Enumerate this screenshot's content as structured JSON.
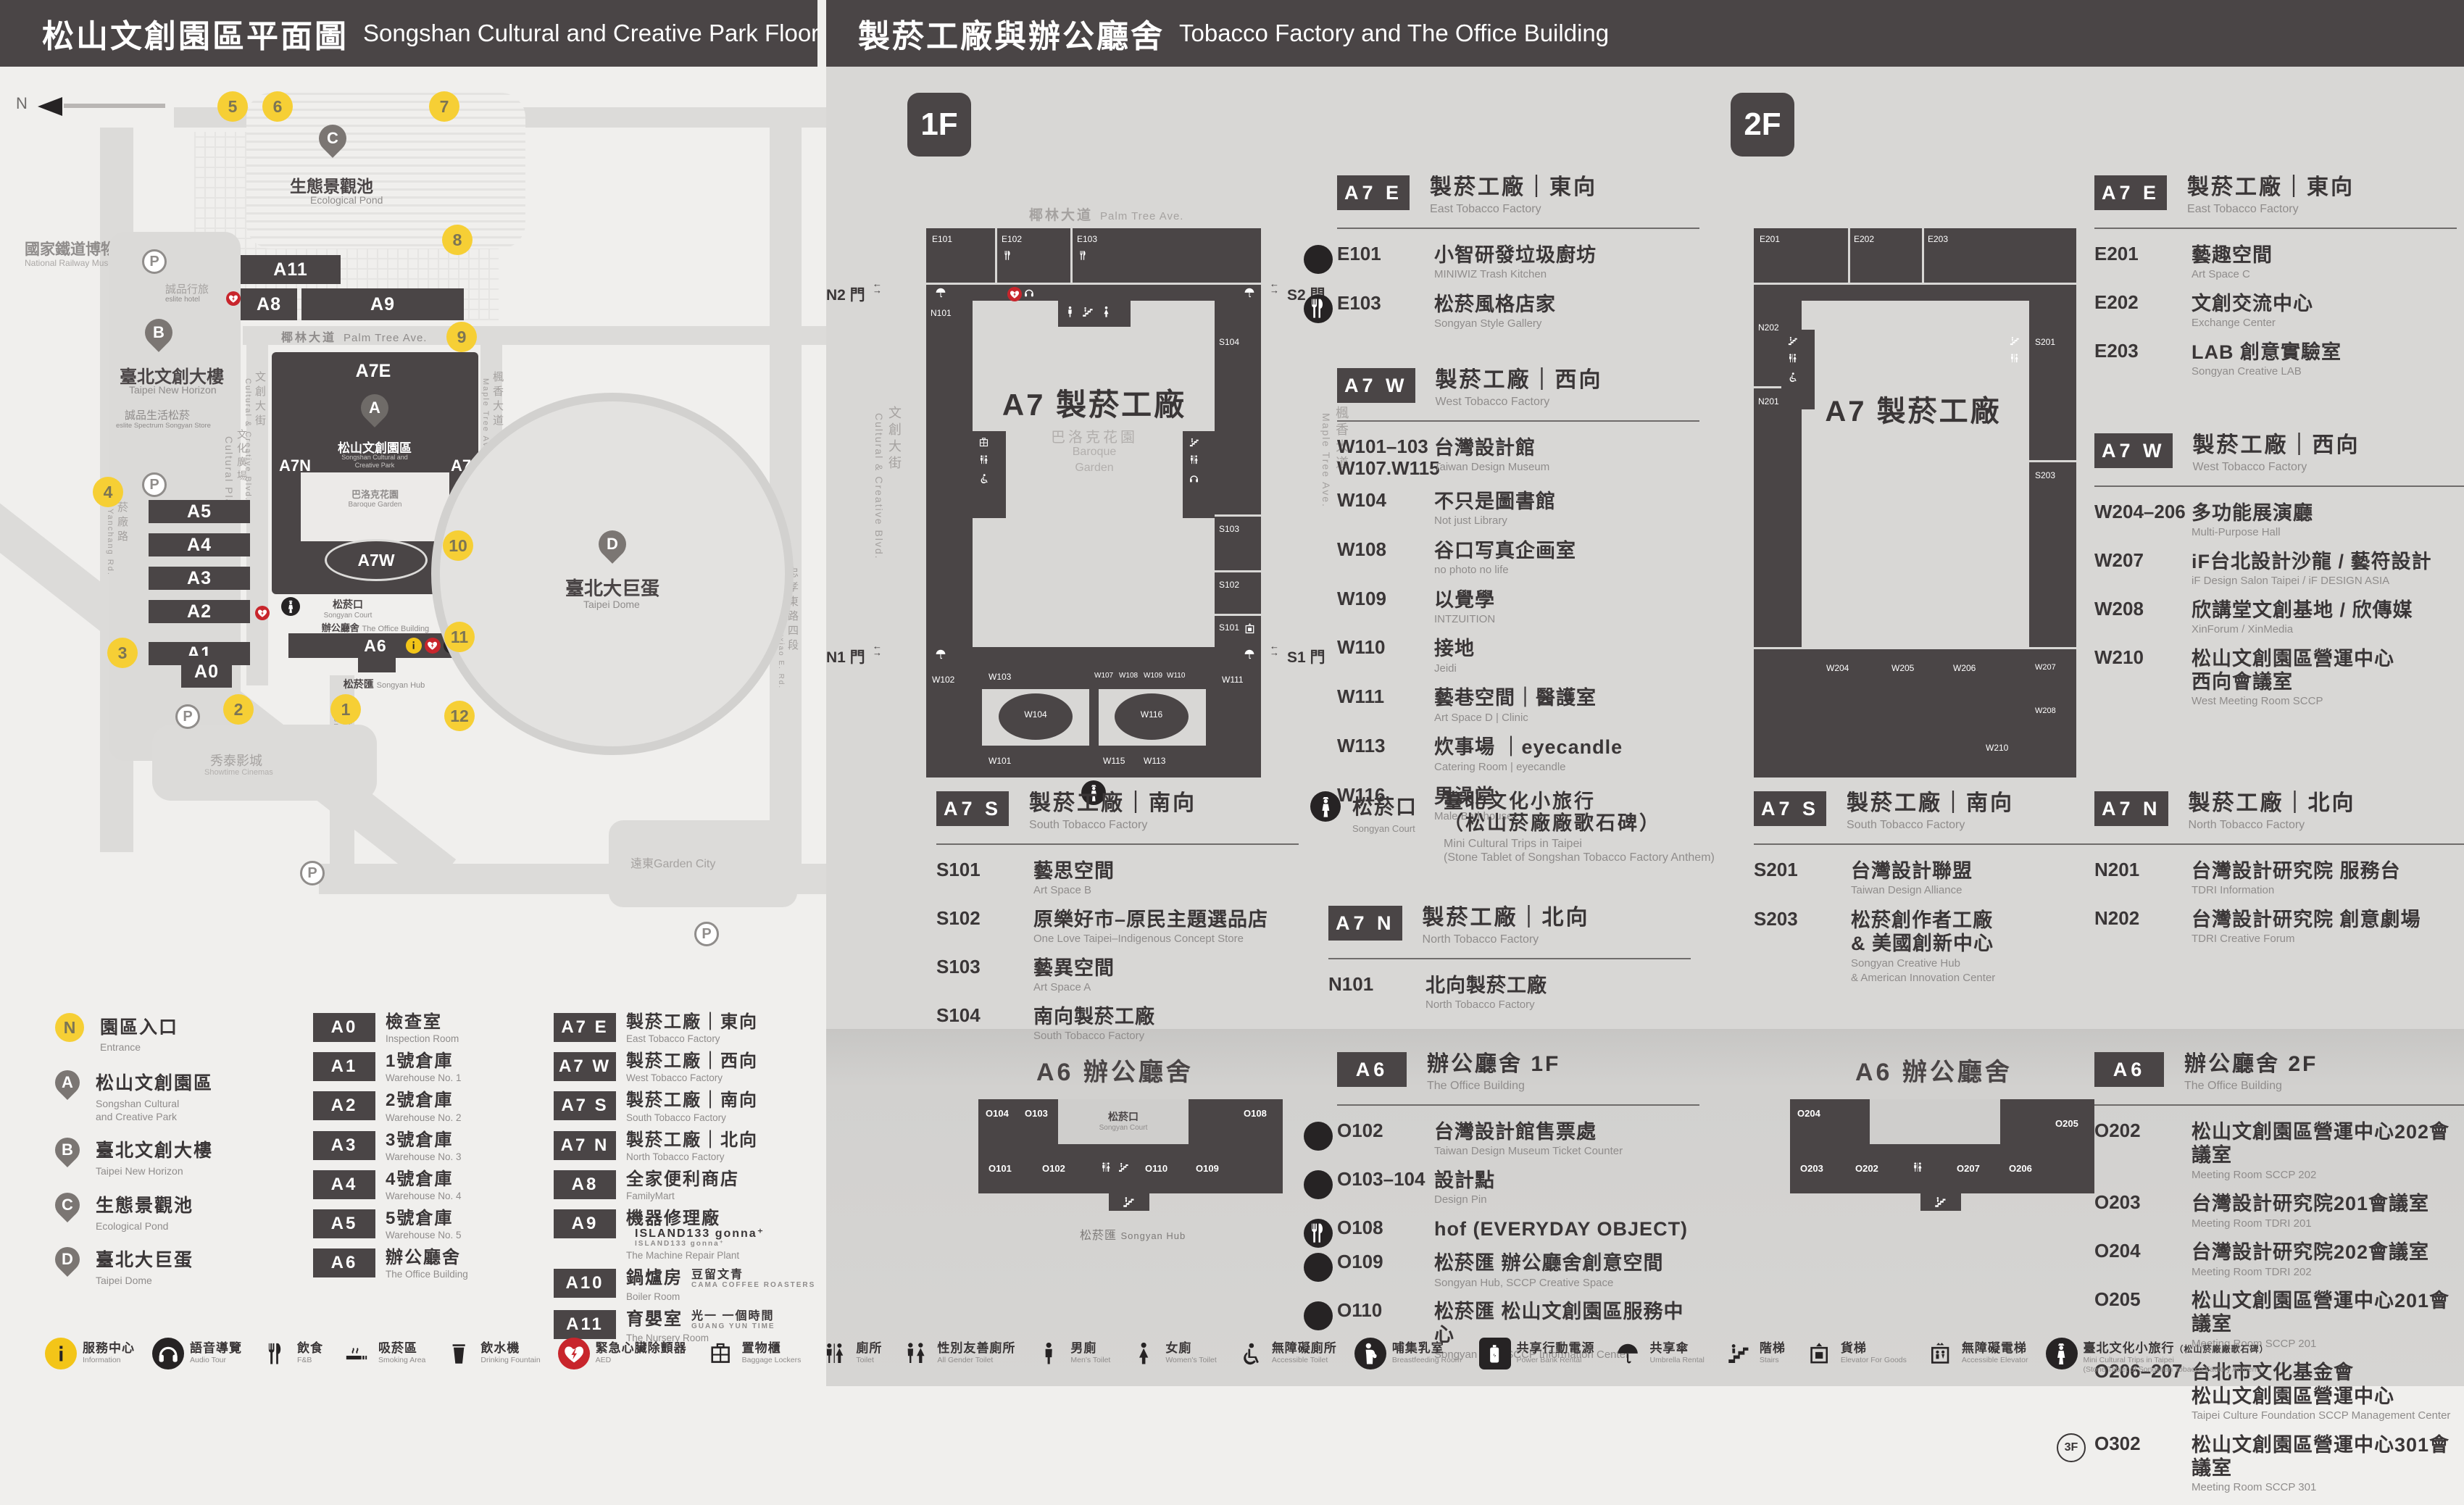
{
  "header": {
    "left": {
      "zh": "松山文創園區平面圖",
      "en": "Songshan Cultural and Creative Park Floor Plan"
    },
    "right": {
      "zh": "製菸工廠與辦公廳舍",
      "en": "Tobacco Factory and The Office Building"
    }
  },
  "map": {
    "compass": "N",
    "railway_museum": {
      "zh": "國家鐵道博物館",
      "en": "National Railway Museum"
    },
    "pond": {
      "pin": "C",
      "zh": "生態景觀池",
      "en": "Ecological Pond"
    },
    "new_horizon": {
      "pin": "B",
      "zh": "臺北文創大樓",
      "en": "Taipei New Horizon"
    },
    "eslite_hotel": {
      "zh": "誠品行旅",
      "en": "eslite hotel"
    },
    "eslite_mall": {
      "zh": "誠品生活松菸",
      "en": "eslite Spectrum Songyan Store"
    },
    "cultural_plaza": {
      "zh": "文化廣場",
      "en": "Cultural Plaza"
    },
    "park": {
      "pin": "A",
      "zh": "松山文創園區",
      "en1": "Songshan Cultural and",
      "en2": "Creative Park"
    },
    "baroque": {
      "zh": "巴洛克花園",
      "en": "Baroque Garden"
    },
    "court": {
      "zh": "松菸口",
      "en": "Songyan Court"
    },
    "office": {
      "zh": "辦公廳舍",
      "en": "The Office Building"
    },
    "hub": {
      "zh": "松菸匯",
      "en": "Songyan Hub"
    },
    "dome": {
      "pin": "D",
      "zh": "臺北大巨蛋",
      "en": "Taipei Dome"
    },
    "showtime": {
      "zh": "秀泰影城",
      "en": "Showtime Cinemas"
    },
    "garden_city": {
      "zh": "遠東Garden City"
    },
    "roads": {
      "palm": {
        "zh": "椰林大道",
        "en": "Palm Tree Ave."
      },
      "cultural": {
        "zh": "文創大街",
        "en": "Cultural & Creative Blvd."
      },
      "maple": {
        "zh": "楓香大道",
        "en": "Maple Tree Ave."
      },
      "yanchang": {
        "zh": "菸廠路",
        "en": "Yanchang Rd."
      },
      "songyan": {
        "zh": "松菸大道",
        "en": "Songyan Ave."
      },
      "zhongxiao": {
        "zh": "忠孝東路四段",
        "en": "Sec. 4, Zhongxiao E. Rd."
      }
    },
    "blocks": {
      "a11": "A11",
      "a8": "A8",
      "a9": "A9",
      "a7e": "A7E",
      "a7n": "A7N",
      "a7s": "A7S",
      "a7w": "A7W",
      "a6": "A6",
      "a5": "A5",
      "a4": "A4",
      "a3": "A3",
      "a2": "A2",
      "a1": "A1",
      "a0": "A0"
    },
    "entrances": [
      "1",
      "2",
      "3",
      "4",
      "5",
      "6",
      "7",
      "8",
      "9",
      "10",
      "11",
      "12"
    ],
    "parking": "P"
  },
  "park_legend": {
    "entrance": {
      "badge": "N",
      "zh": "園區入口",
      "en": "Entrance"
    },
    "pins": [
      {
        "badge": "A",
        "zh": "松山文創園區",
        "en": "Songshan Cultural",
        "en2": "and Creative Park"
      },
      {
        "badge": "B",
        "zh": "臺北文創大樓",
        "en": "Taipei New Horizon"
      },
      {
        "badge": "C",
        "zh": "生態景觀池",
        "en": "Ecological Pond"
      },
      {
        "badge": "D",
        "zh": "臺北大巨蛋",
        "en": "Taipei Dome"
      }
    ]
  },
  "building_legend": {
    "col1": [
      {
        "code": "A0",
        "zh": "檢查室",
        "en": "Inspection Room",
        "icons": []
      },
      {
        "code": "A1",
        "zh": "1號倉庫",
        "en": "Warehouse No. 1",
        "icons": [
          "goods-elevator-icon",
          "toilet-icon"
        ]
      },
      {
        "code": "A2",
        "zh": "2號倉庫",
        "en": "Warehouse No. 2",
        "icons": [
          "aed-icon"
        ]
      },
      {
        "code": "A3",
        "zh": "3號倉庫",
        "en": "Warehouse No. 3",
        "icons": []
      },
      {
        "code": "A4",
        "zh": "4號倉庫",
        "en": "Warehouse No. 4",
        "icons": []
      },
      {
        "code": "A5",
        "zh": "5號倉庫",
        "en": "Warehouse No. 5",
        "icons": []
      },
      {
        "code": "A6",
        "zh": "辦公廳舍",
        "en": "The Office Building",
        "icons": [
          "aed-icon",
          "toilet-icon",
          "fnb-icon",
          "info-icon"
        ]
      }
    ],
    "col2": [
      {
        "code": "A7 E",
        "zh": "製菸工廠｜東向",
        "en": "East Tobacco Factory",
        "icons": [
          "aed-icon",
          "toilet-icon",
          "fnb-icon"
        ]
      },
      {
        "code": "A7 W",
        "zh": "製菸工廠｜西向",
        "en": "West Tobacco Factory",
        "icons": [
          "mini-trips-icon",
          "toilet-icon"
        ]
      },
      {
        "code": "A7 S",
        "zh": "製菸工廠｜南向",
        "en": "South Tobacco Factory",
        "icons": [
          "toilet-icon"
        ]
      },
      {
        "code": "A7 N",
        "zh": "製菸工廠｜北向",
        "en": "North Tobacco Factory",
        "icons": [
          "toilet-icon"
        ]
      },
      {
        "code": "A8",
        "zh": "全家便利商店",
        "en": "FamilyMart",
        "icons": [
          "goods-elevator-icon",
          "aed-icon",
          "fnb-icon"
        ]
      },
      {
        "code": "A9",
        "zh": "機器修理廠",
        "en": "The Machine Repair Plant",
        "brand": "ISLAND133 gonna⁺",
        "brand_sub": "ISLAND133 gonna⁺",
        "icons": [
          "fnb-icon"
        ]
      },
      {
        "code": "A10",
        "zh": "鍋爐房",
        "en": "Boiler Room",
        "brand": "豆留文青",
        "brand_sub": "CAMA COFFEE ROASTERS",
        "icons": [
          "fnb-icon"
        ]
      },
      {
        "code": "A11",
        "zh": "育嬰室",
        "en": "The Nursery Room",
        "brand": "光一 一個時間",
        "brand_sub": "GUANG YUN TIME",
        "icons": [
          "fnb-icon"
        ]
      }
    ]
  },
  "services": [
    {
      "icon": "info-icon",
      "cls": "ic-yellow-round",
      "zh": "服務中心",
      "en": "Information"
    },
    {
      "icon": "audio-tour-icon",
      "cls": "ic-black-round",
      "zh": "語音導覽",
      "en": "Audio Tour"
    },
    {
      "icon": "fnb-icon",
      "cls": "",
      "zh": "飲食",
      "en": "F&B"
    },
    {
      "icon": "smoking-icon",
      "cls": "",
      "zh": "吸菸區",
      "en": "Smoking Area"
    },
    {
      "icon": "drinking-fountain-icon",
      "cls": "",
      "zh": "飲水機",
      "en": "Drinking Fountain"
    },
    {
      "icon": "aed-icon",
      "cls": "ic-red-round",
      "zh": "緊急心臟除顫器",
      "en": "AED"
    },
    {
      "icon": "lockers-icon",
      "cls": "",
      "zh": "置物櫃",
      "en": "Baggage Lockers"
    },
    {
      "icon": "toilet-icon",
      "cls": "",
      "zh": "廁所",
      "en": "Toilet"
    },
    {
      "icon": "all-gender-toilet-icon",
      "cls": "",
      "zh": "性別友善廁所",
      "en": "All Gender Toilet"
    },
    {
      "icon": "mens-toilet-icon",
      "cls": "",
      "zh": "男廁",
      "en": "Men's Toilet"
    },
    {
      "icon": "womens-toilet-icon",
      "cls": "",
      "zh": "女廁",
      "en": "Women's Toilet"
    },
    {
      "icon": "accessible-toilet-icon",
      "cls": "",
      "zh": "無障礙廁所",
      "en": "Accessible Toilet"
    },
    {
      "icon": "breastfeeding-icon",
      "cls": "ic-black-round",
      "zh": "哺集乳室",
      "en": "Breastfeeding Room"
    },
    {
      "icon": "power-bank-icon",
      "cls": "ic-dark-square",
      "zh": "共享行動電源",
      "en": "Power Bank Rental"
    },
    {
      "icon": "umbrella-icon",
      "cls": "",
      "zh": "共享傘",
      "en": "Umbrella Rental"
    },
    {
      "icon": "stairs-icon",
      "cls": "",
      "zh": "階梯",
      "en": "Stairs"
    },
    {
      "icon": "goods-elevator-icon",
      "cls": "",
      "zh": "貨梯",
      "en": "Elevator For Goods"
    },
    {
      "icon": "accessible-elevator-icon",
      "cls": "",
      "zh": "無障礙電梯",
      "en": "Accessible Elevator"
    },
    {
      "icon": "mini-trips-icon",
      "cls": "ic-black-round",
      "zh": "臺北文化小旅行",
      "zh_small": "（松山菸廠廠歌石碑）",
      "en": "Mini Cultural Trips in Taipei",
      "en2": "(Stone Tablet of Songshan Tobacco Factory Anthem)"
    }
  ],
  "floor1": {
    "badge": "1F",
    "plan": {
      "road_top_zh": "椰林大道",
      "road_top_en": "Palm Tree Ave.",
      "road_left_zh": "文創大街",
      "road_left_en": "Cultural & Creative Blvd.",
      "road_right_zh": "楓香大道",
      "road_right_en": "Maple Tree Ave.",
      "center": "A7 製菸工廠",
      "courtyard_zh": "巴洛克花園",
      "courtyard_en1": "Baroque",
      "courtyard_en2": "Garden",
      "gate_n2": "N2 門",
      "gate_s2": "S2 門",
      "gate_n1": "N1 門",
      "gate_s1": "S1 門",
      "rooms": {
        "e101": "E101",
        "e102": "E102",
        "e103": "E103",
        "n101": "N101",
        "s104": "S104",
        "s103": "S103",
        "s102": "S102",
        "s101": "S101",
        "w102": "W102",
        "w103": "W103",
        "w104": "W104",
        "w101": "W101",
        "w107": "W107",
        "w108": "W108",
        "w109": "W109",
        "w110": "W110",
        "w111": "W111",
        "w115": "W115",
        "w113": "W113",
        "w116": "W116"
      }
    },
    "a7e": {
      "code": "A7 E",
      "zh": "製菸工廠｜東向",
      "en": "East Tobacco Factory",
      "rooms": [
        {
          "code": "E101",
          "zh": "小智研發垃圾廚坊",
          "en": "MINIWIZ Trash Kitchen"
        },
        {
          "code": "E103",
          "zh": "松菸風格店家",
          "en": "Songyan Style Gallery",
          "icon": "fnb-icon"
        }
      ]
    },
    "a7w": {
      "code": "A7 W",
      "zh": "製菸工廠｜西向",
      "en": "West Tobacco Factory",
      "rooms": [
        {
          "code": "W101–103",
          "code2": "W107.W115",
          "zh": "台灣設計館",
          "en": "Taiwan Design Museum"
        },
        {
          "code": "W104",
          "zh": "不只是圖書館",
          "en": "Not just Library"
        },
        {
          "code": "W108",
          "zh": "谷口写真企画室",
          "en": "no photo no life"
        },
        {
          "code": "W109",
          "zh": "以覺學",
          "en": "INTZUITION"
        },
        {
          "code": "W110",
          "zh": "接地",
          "en": "Jeidi"
        },
        {
          "code": "W111",
          "zh": "藝巷空間｜醫護室",
          "en": "Art Space D | Clinic"
        },
        {
          "code": "W113",
          "zh": "炊事場 ｜eyecandle",
          "en": "Catering Room | eyecandle"
        },
        {
          "code": "W116",
          "zh": "男澡堂",
          "en": "Male Bathhouse"
        }
      ]
    },
    "a7s": {
      "code": "A7 S",
      "zh": "製菸工廠｜南向",
      "en": "South Tobacco Factory",
      "rooms": [
        {
          "code": "S101",
          "zh": "藝思空間",
          "en": "Art Space B"
        },
        {
          "code": "S102",
          "zh": "原樂好市–原民主題選品店",
          "en": "One Love Taipei–Indigenous Concept Store"
        },
        {
          "code": "S103",
          "zh": "藝異空間",
          "en": "Art Space A"
        },
        {
          "code": "S104",
          "zh": "南向製菸工廠",
          "en": "South Tobacco Factory"
        }
      ]
    },
    "court": {
      "zh": "松菸口",
      "en": "Songyan Court",
      "name_zh": "臺北文化小旅行",
      "name_zh2": "（松山菸廠廠歌石碑）",
      "name_en": "Mini Cultural Trips in Taipei",
      "name_en2": "(Stone Tablet of Songshan Tobacco Factory Anthem)"
    },
    "a7n": {
      "code": "A7 N",
      "zh": "製菸工廠｜北向",
      "en": "North Tobacco Factory",
      "rooms": [
        {
          "code": "N101",
          "zh": "北向製菸工廠",
          "en": "North Tobacco Factory"
        }
      ]
    }
  },
  "floor2": {
    "badge": "2F",
    "plan": {
      "center": "A7 製菸工廠",
      "rooms": {
        "e201": "E201",
        "e202": "E202",
        "e203": "E203",
        "n202": "N202",
        "n201": "N201",
        "s201": "S201",
        "s203": "S203",
        "w204": "W204",
        "w205": "W205",
        "w206": "W206",
        "w207": "W207",
        "w208": "W208",
        "w210": "W210"
      }
    },
    "a7e": {
      "code": "A7 E",
      "zh": "製菸工廠｜東向",
      "en": "East Tobacco Factory",
      "rooms": [
        {
          "code": "E201",
          "zh": "藝趣空間",
          "en": "Art Space C"
        },
        {
          "code": "E202",
          "zh": "文創交流中心",
          "en": "Exchange Center"
        },
        {
          "code": "E203",
          "zh": "LAB 創意實驗室",
          "en": "Songyan Creative LAB"
        }
      ]
    },
    "a7w": {
      "code": "A7 W",
      "zh": "製菸工廠｜西向",
      "en": "West Tobacco Factory",
      "rooms": [
        {
          "code": "W204–206",
          "zh": "多功能展演廳",
          "en": "Multi-Purpose Hall"
        },
        {
          "code": "W207",
          "zh": "iF台北設計沙龍 / 藝符設計",
          "en": "iF Design Salon Taipei / iF DESIGN ASIA"
        },
        {
          "code": "W208",
          "zh": "欣講堂文創基地 / 欣傳媒",
          "en": "XinForum / XinMedia"
        },
        {
          "code": "W210",
          "zh": "松山文創園區營運中心",
          "zh2": "西向會議室",
          "en": "West Meeting Room SCCP"
        }
      ]
    },
    "a7s": {
      "code": "A7 S",
      "zh": "製菸工廠｜南向",
      "en": "South Tobacco Factory",
      "rooms": [
        {
          "code": "S201",
          "zh": "台灣設計聯盟",
          "en": "Taiwan Design Alliance"
        },
        {
          "code": "S203",
          "zh": "松菸創作者工廠",
          "zh2": "& 美國創新中心",
          "en": "Songyan Creative Hub",
          "en2": "& American Innovation Center"
        }
      ]
    },
    "a7n": {
      "code": "A7 N",
      "zh": "製菸工廠｜北向",
      "en": "North Tobacco Factory",
      "rooms": [
        {
          "code": "N201",
          "zh": "台灣設計研究院 服務台",
          "en": "TDRI Information"
        },
        {
          "code": "N202",
          "zh": "台灣設計研究院 創意劇場",
          "en": "TDRI Creative Forum"
        }
      ]
    }
  },
  "a6f1": {
    "code": "A6",
    "zh": "辦公廳舍 1F",
    "en": "The Office Building",
    "plan_title": "A6 辦公廳舍",
    "plan": {
      "o104": "O104",
      "o103": "O103",
      "o108": "O108",
      "o101": "O101",
      "o102": "O102",
      "o110": "O110",
      "o109": "O109",
      "court_zh": "松菸口",
      "court_en": "Songyan Court",
      "hub_zh": "松菸匯",
      "hub_en": "Songyan Hub"
    },
    "rooms": [
      {
        "code": "O102",
        "zh": "台灣設計館售票處",
        "en": "Taiwan Design Museum Ticket Counter"
      },
      {
        "code": "O103–104",
        "zh": "設計點",
        "en": "Design Pin"
      },
      {
        "code": "O108",
        "zh": "hof (EVERYDAY OBJECT)",
        "icon": "fnb-icon"
      },
      {
        "code": "O109",
        "zh": "松菸匯 辦公廳舍創意空間",
        "en": "Songyan Hub, SCCP Creative Space"
      },
      {
        "code": "O110",
        "zh": "松菸匯 松山文創園區服務中心",
        "en": "Songyan Hub, SCCP Information Center"
      }
    ]
  },
  "a6f2": {
    "code": "A6",
    "zh": "辦公廳舍 2F",
    "en": "The Office Building",
    "plan_title": "A6 辦公廳舍",
    "plan": {
      "o204": "O204",
      "o205": "O205",
      "o203": "O203",
      "o202": "O202",
      "o207": "O207",
      "o206": "O206"
    },
    "rooms": [
      {
        "code": "O202",
        "zh": "松山文創園區營運中心202會議室",
        "en": "Meeting Room SCCP 202"
      },
      {
        "code": "O203",
        "zh": "台灣設計研究院201會議室",
        "en": "Meeting Room TDRI 201"
      },
      {
        "code": "O204",
        "zh": "台灣設計研究院202會議室",
        "en": "Meeting Room TDRI 202"
      },
      {
        "code": "O205",
        "zh": "松山文創園區營運中心201會議室",
        "en": "Meeting Room SCCP 201"
      },
      {
        "code": "O206–207",
        "zh": "台北市文化基金會",
        "zh2": "松山文創園區營運中心",
        "en": "Taipei Culture Foundation SCCP Management Center"
      },
      {
        "code": "O302",
        "prefix": "3F",
        "zh": "松山文創園區營運中心301會議室",
        "en": "Meeting Room SCCP 301"
      }
    ]
  }
}
